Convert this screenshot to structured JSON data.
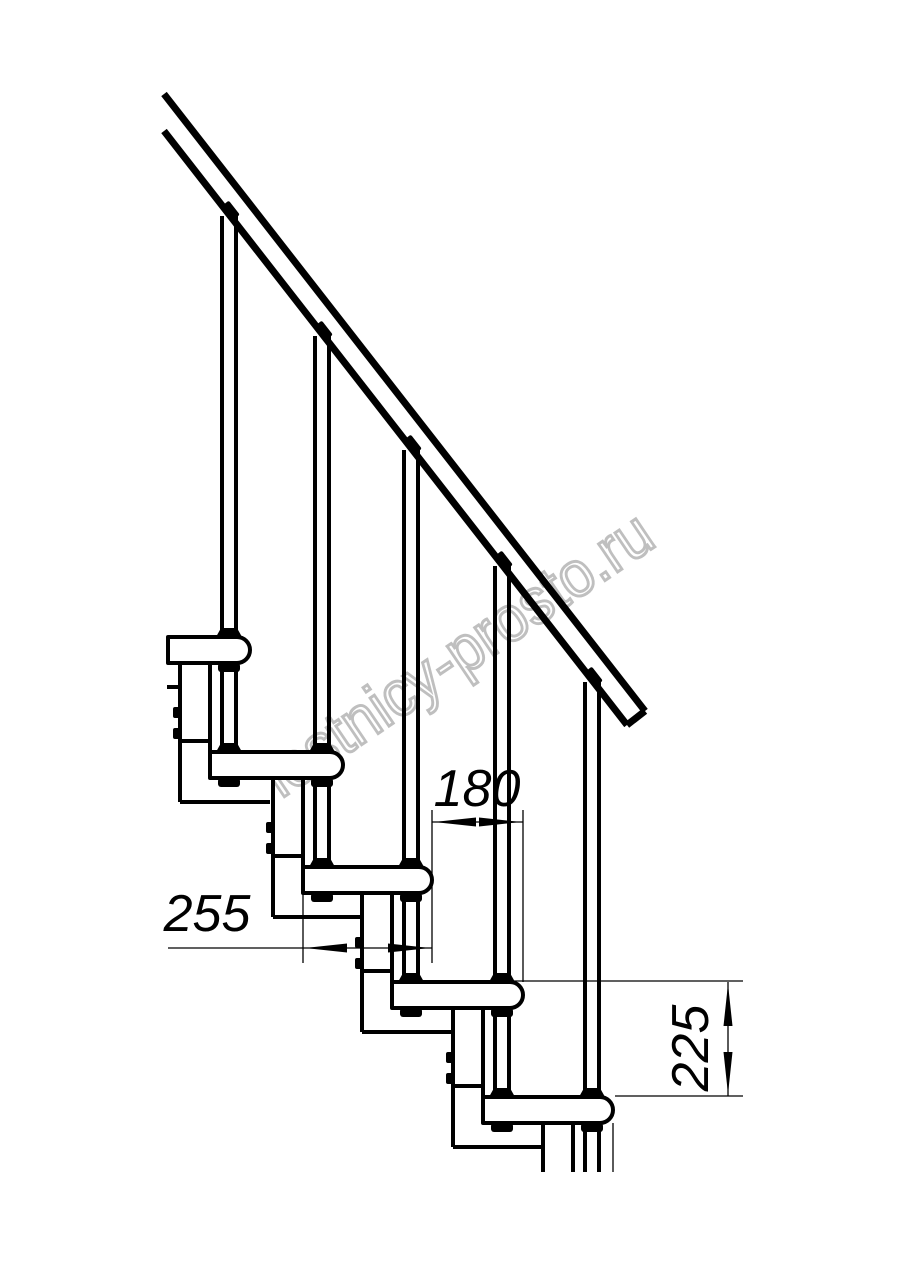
{
  "page": {
    "background": "#ffffff",
    "line_color": "#000000",
    "description": "Side-view technical drawing of a modular staircase with handrail, balusters, treads, support columns and dimension callouts"
  },
  "watermark": {
    "text": "lestnicy-prosto.ru",
    "color": "#bfbfbf",
    "rotation_deg": -34
  },
  "dimensions": [
    {
      "id": "tread-depth",
      "value": "255",
      "orientation": "horizontal"
    },
    {
      "id": "step-run",
      "value": "180",
      "orientation": "horizontal"
    },
    {
      "id": "step-rise",
      "value": "225",
      "orientation": "vertical"
    }
  ],
  "structure": {
    "visible_treads": 5,
    "visible_balusters": 5,
    "handrail": "diagonal, top-left to mid-right",
    "support": "stacked modular columns with bolt details"
  }
}
